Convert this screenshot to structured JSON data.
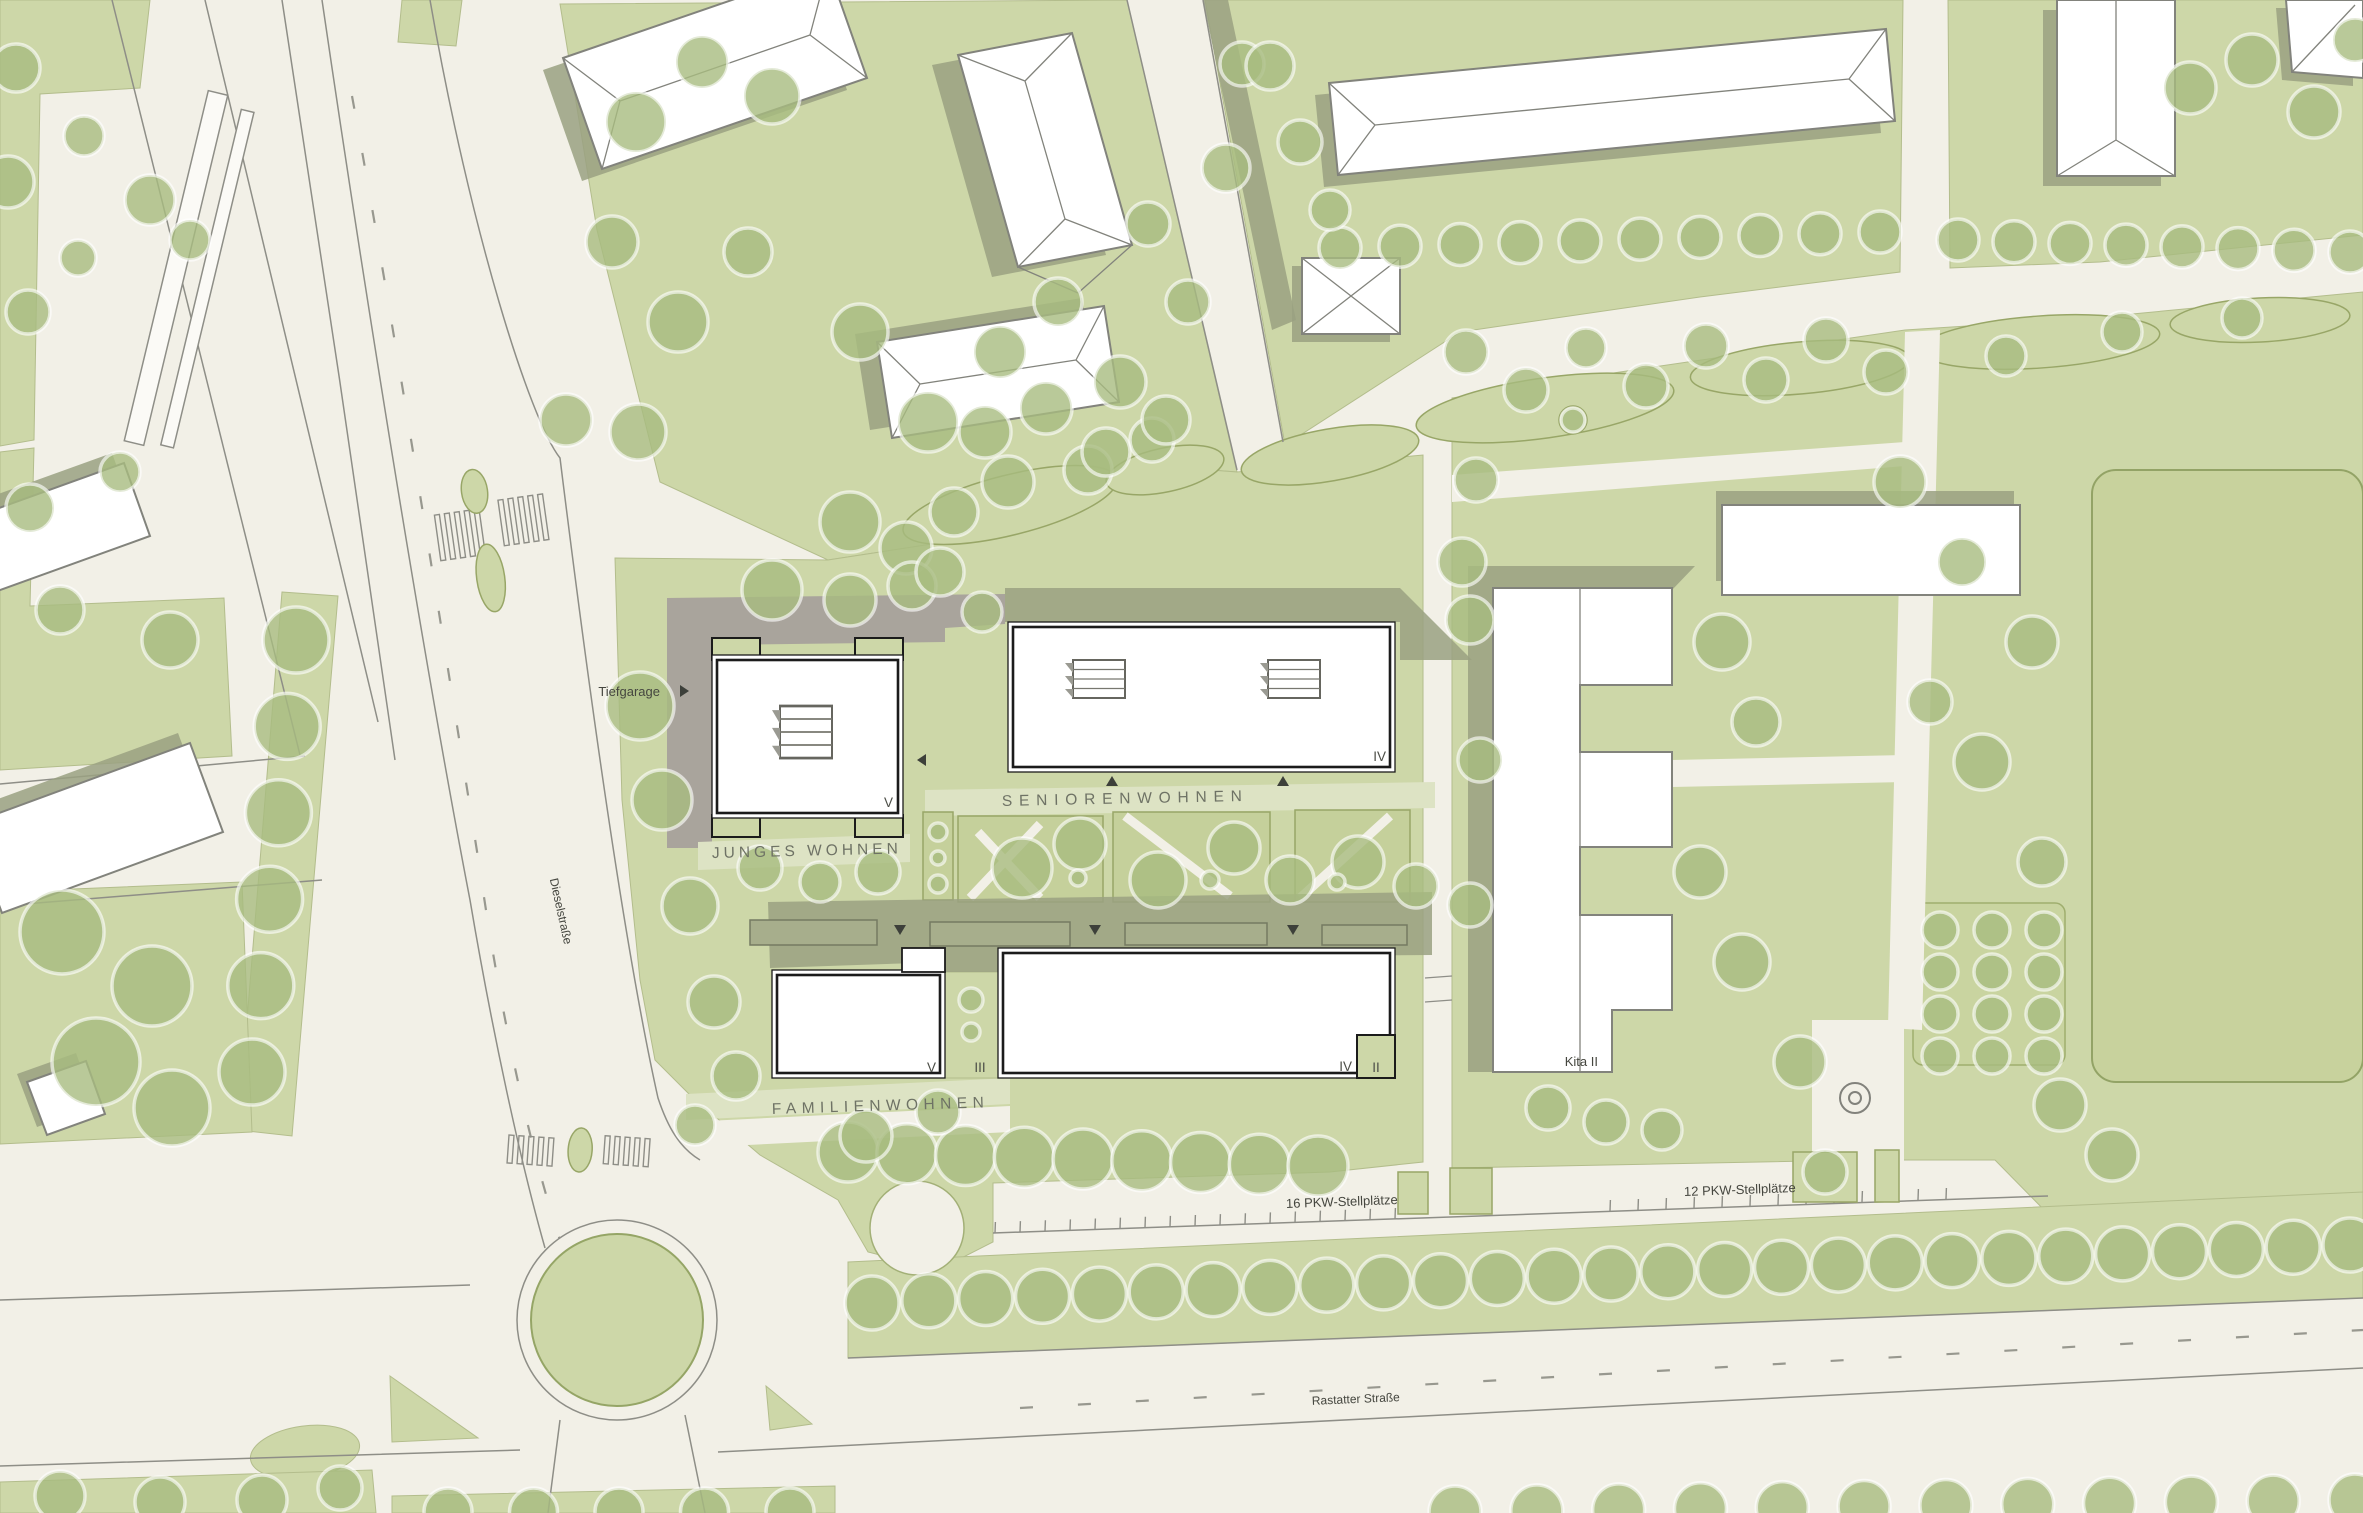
{
  "labels": {
    "junges_wohnen": "JUNGES WOHNEN",
    "seniorenwohnen": "SENIORENWOHNEN",
    "familienwohnen": "FAMILIENWOHNEN",
    "tiefgarage": "Tiefgarage",
    "kita": "Kita II",
    "parking_16": "16 PKW-Stellplätze",
    "parking_12": "12 PKW-Stellplätze",
    "street_diesel": "Dieselstraße",
    "street_rastatter": "Rastatter Straße"
  },
  "buildings": [
    {
      "name": "Junges Wohnen",
      "floors": "V"
    },
    {
      "name": "Seniorenwohnen",
      "floors": "IV"
    },
    {
      "name": "Familienwohnen West",
      "floors": "V"
    },
    {
      "name": "Familienwohnen Verbinder",
      "floors": "III"
    },
    {
      "name": "Familienwohnen Ost",
      "floors": "IV"
    },
    {
      "name": "Familienwohnen Anbau",
      "floors": "II"
    },
    {
      "name": "Kita",
      "floors": "II"
    }
  ],
  "floors": {
    "jw": "V",
    "sw": "IV",
    "fw_west": "V",
    "fw_mid": "III",
    "fw_east": "IV",
    "fw_annex": "II"
  },
  "colors": {
    "cream": "#f2f0e7",
    "green": "#cdd7a8",
    "green_light": "#dde3c4",
    "plot": "#c5d09b",
    "field": "#c8d29d",
    "tree": "#a7bb80",
    "olive": "#9aa181",
    "gray_zone": "#a9a49c",
    "curb": "#8e8e87",
    "building_stroke": "#82837c",
    "new_building_stroke": "#1b1b1b",
    "plot_stroke": "#98a667",
    "text_dark": "#45463f",
    "text_muted": "#6e7265"
  }
}
